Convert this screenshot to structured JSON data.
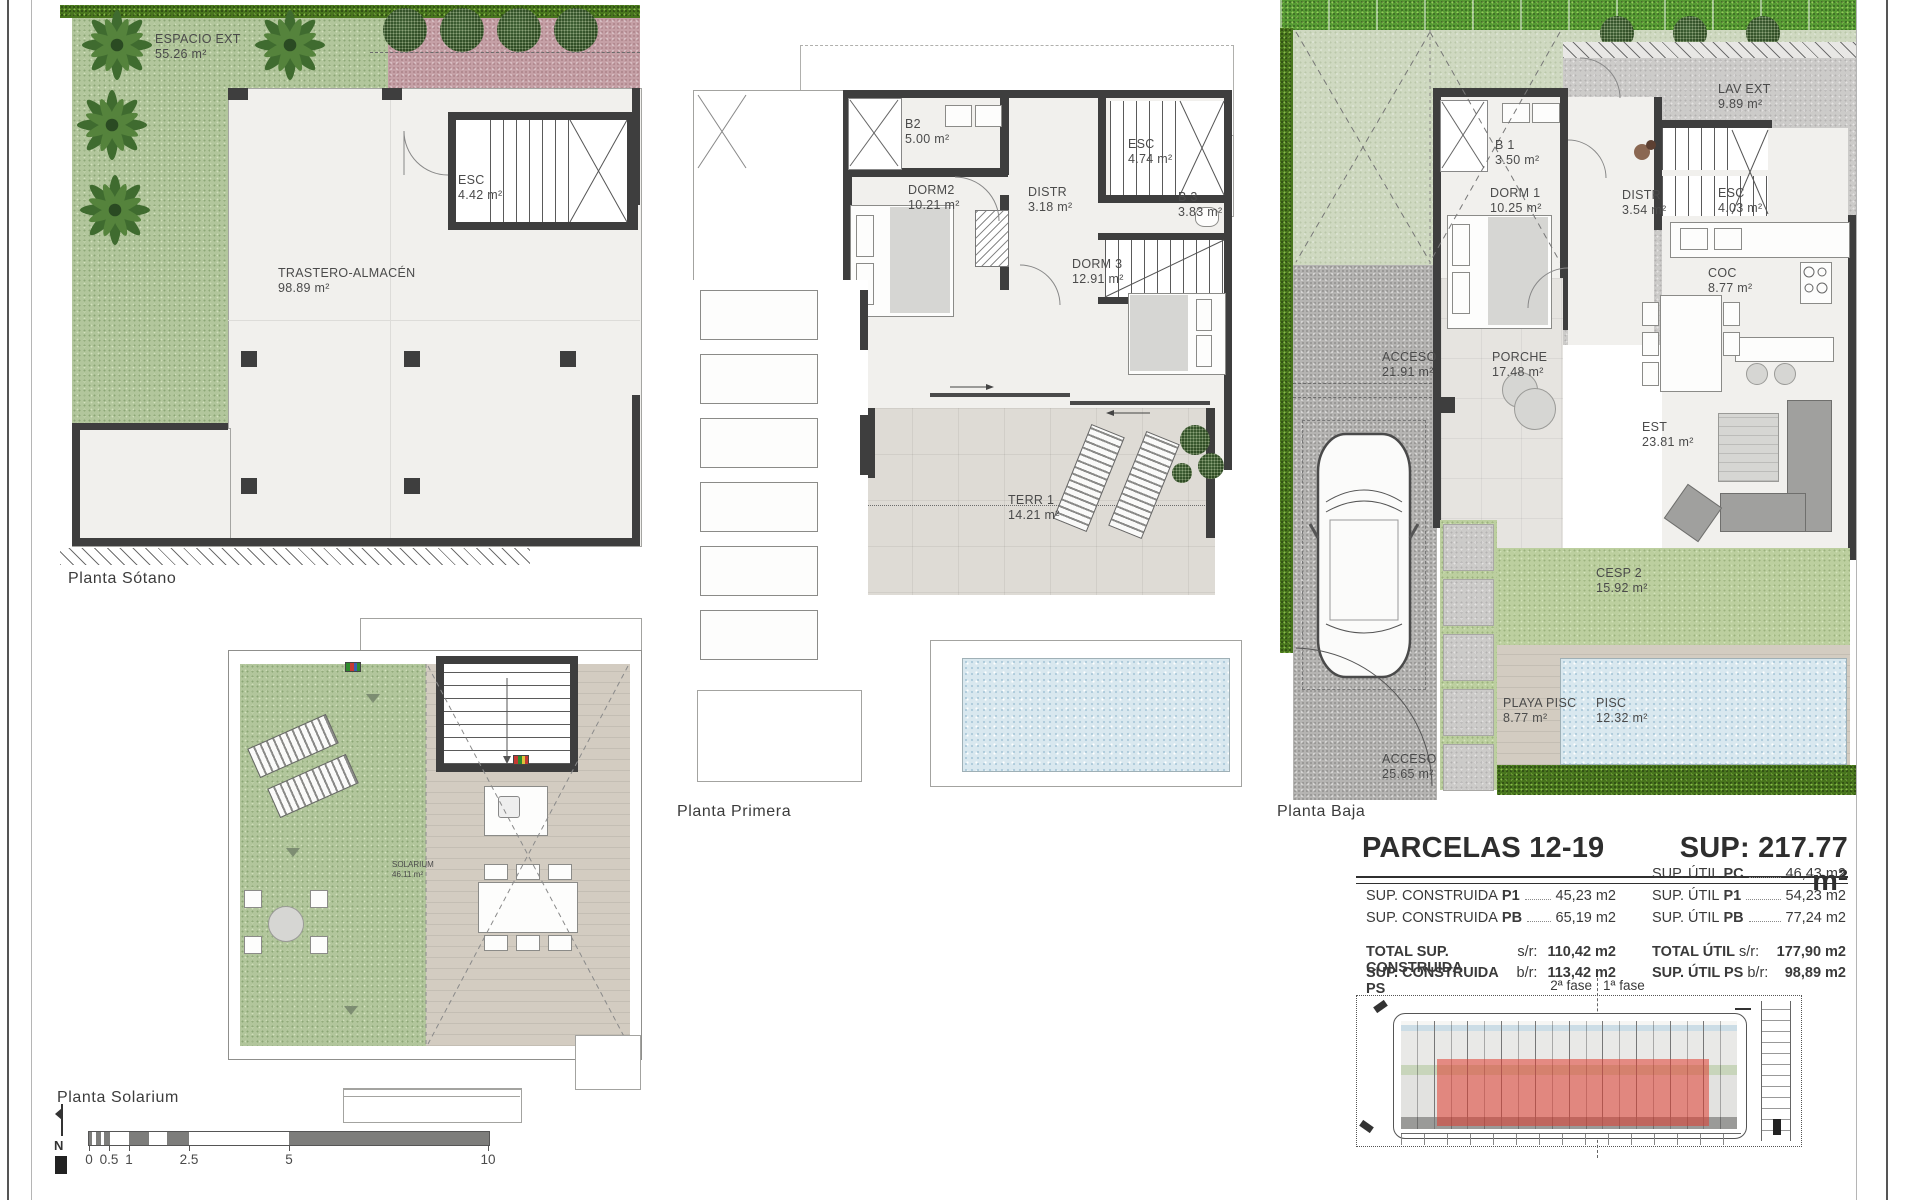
{
  "plans": {
    "sotano": {
      "title": "Planta Sótano",
      "rooms": [
        {
          "name": "ESPACIO EXT",
          "area": "55.26 m²"
        },
        {
          "name": "ESC",
          "area": "4.42 m²"
        },
        {
          "name": "TRASTERO-ALMACÉN",
          "area": "98.89 m²"
        }
      ]
    },
    "solarium": {
      "title": "Planta Solarium",
      "rooms": [
        {
          "name": "SOLARIUM",
          "area": "46.11 m²"
        }
      ]
    },
    "primera": {
      "title": "Planta Primera",
      "rooms": [
        {
          "name": "B2",
          "area": "5.00 m²"
        },
        {
          "name": "DORM2",
          "area": "10.21 m²"
        },
        {
          "name": "DISTR",
          "area": "3.18 m²"
        },
        {
          "name": "ESC",
          "area": "4.74 m²"
        },
        {
          "name": "B 3",
          "area": "3.83 m²"
        },
        {
          "name": "DORM 3",
          "area": "12.91 m²"
        },
        {
          "name": "TERR 1",
          "area": "14.21 m²"
        }
      ]
    },
    "baja": {
      "title": "Planta Baja",
      "rooms": [
        {
          "name": "LAV EXT",
          "area": "9.89 m²"
        },
        {
          "name": "B 1",
          "area": "3.50 m²"
        },
        {
          "name": "DORM 1",
          "area": "10.25 m²"
        },
        {
          "name": "DISTR",
          "area": "3.54 m²"
        },
        {
          "name": "ESC",
          "area": "4.03 m²"
        },
        {
          "name": "COC",
          "area": "8.77 m²"
        },
        {
          "name": "ACCESO",
          "area": "21.91 m²"
        },
        {
          "name": "PORCHE",
          "area": "17.48 m²"
        },
        {
          "name": "EST",
          "area": "23.81 m²"
        },
        {
          "name": "CESP 2",
          "area": "15.92 m²"
        },
        {
          "name": "PLAYA PISC",
          "area": "8.77 m²"
        },
        {
          "name": "PISC",
          "area": "12.32 m²"
        },
        {
          "name": "ACCESO",
          "area": "25.65 m²"
        }
      ]
    }
  },
  "summary": {
    "title": "PARCELAS 12-19",
    "sup_total": "SUP: 217.77 m²",
    "constructed": [
      {
        "label": "SUP. CONSTRUIDA",
        "key": "P1",
        "value": "45,23 m2"
      },
      {
        "label": "SUP. CONSTRUIDA",
        "key": "PB",
        "value": "65,19 m2"
      }
    ],
    "useful": [
      {
        "label": "SUP. ÚTIL",
        "key": "PC",
        "value": "46,43 m2"
      },
      {
        "label": "SUP. ÚTIL",
        "key": "P1",
        "value": "54,23 m2"
      },
      {
        "label": "SUP. ÚTIL",
        "key": "PB",
        "value": "77,24 m2"
      }
    ],
    "totals_left": [
      {
        "label": "TOTAL SUP. CONSTRUIDA",
        "key": "s/r:",
        "value": "110,42 m2"
      },
      {
        "label": "SUP. CONSTRUIDA PS",
        "key": "b/r:",
        "value": "113,42 m2"
      }
    ],
    "totals_right": [
      {
        "label": "TOTAL ÚTIL",
        "key": "s/r:",
        "value": "177,90 m2"
      },
      {
        "label": "SUP. ÚTIL PS",
        "key": "b/r:",
        "value": "98,89 m2"
      }
    ],
    "phases": {
      "left": "2ª fase",
      "right": "1ª fase"
    }
  },
  "scalebar": {
    "north": "N",
    "ticks": [
      "0",
      "0.5",
      "1",
      "2.5",
      "5",
      "10"
    ]
  },
  "colors": {
    "red_highlight": "#e03c30",
    "hedge": "#48751d",
    "lawn": "#cfd9c1",
    "pool": "#d9e8ef",
    "gravel": "#b5b4b2",
    "pink_gravel": "#c5a0a6",
    "wall": "#3e3e3e"
  }
}
